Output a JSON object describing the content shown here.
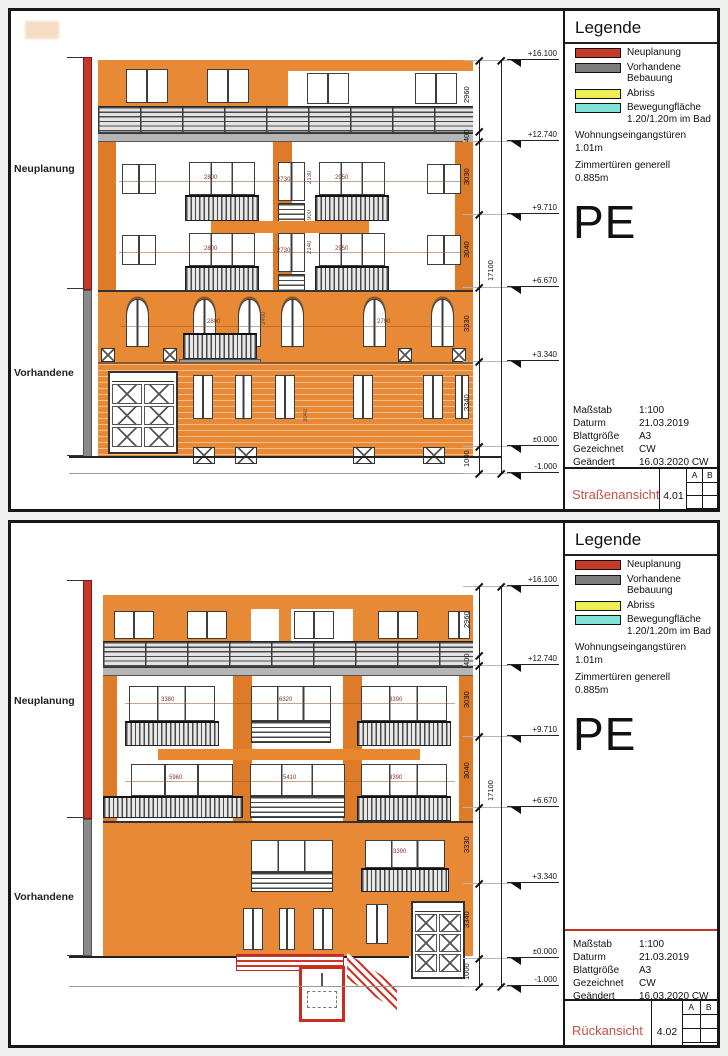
{
  "legend": {
    "title": "Legende",
    "items": [
      {
        "label": "Neuplanung",
        "color": "#c63a2a"
      },
      {
        "label": "Vorhandene Bebauung",
        "color": "#7d7d7d"
      },
      {
        "label": "Abriss",
        "color": "#eeee55"
      },
      {
        "label": "Bewegungfläche 1.20/1.20m im Bad",
        "color": "#7fe3d8"
      }
    ],
    "notes": [
      "Wohnungseingangstüren 1.01m",
      "Zimmertüren generell 0.885m"
    ],
    "mark": "PE"
  },
  "titleblock": {
    "rows": [
      {
        "label": "Maßstab",
        "value": "1:100"
      },
      {
        "label": "Daturm",
        "value": "21.03.2019"
      },
      {
        "label": "Blattgröße",
        "value": "A3"
      },
      {
        "label": "Gezeichnet",
        "value": "CW"
      },
      {
        "label": "Geändert",
        "value": "16.03.2020 CW"
      }
    ],
    "rev_a": "A",
    "rev_b": "B"
  },
  "chain": {
    "markers": [
      "+16.100",
      "+12.740",
      "+9.710",
      "+6.670",
      "+3.340",
      "±0.000",
      "-1.000"
    ],
    "segments": [
      "2960",
      "400",
      "3030",
      "3040",
      "3330",
      "3340",
      "1000"
    ],
    "total": "17100"
  },
  "side_labels": {
    "new": "Neuplanung",
    "existing": "Vorhandene"
  },
  "sheets": [
    {
      "title": "Straßenansicht",
      "number": "4.01",
      "dims": {
        "rowA": [
          "2800",
          "2730",
          "2950"
        ],
        "rowB": [
          "2800",
          "2730",
          "2950"
        ],
        "rowC": [
          "2800",
          "2790"
        ],
        "vert": [
          "2130",
          "900",
          "2140",
          "2400",
          "3040"
        ]
      }
    },
    {
      "title": "Rückansicht",
      "number": "4.02",
      "dims": {
        "rowA": [
          "3380",
          "6320",
          "3390"
        ],
        "rowB": [
          "5960",
          "5410",
          "3390"
        ],
        "rowC": [
          "3390"
        ]
      }
    }
  ]
}
